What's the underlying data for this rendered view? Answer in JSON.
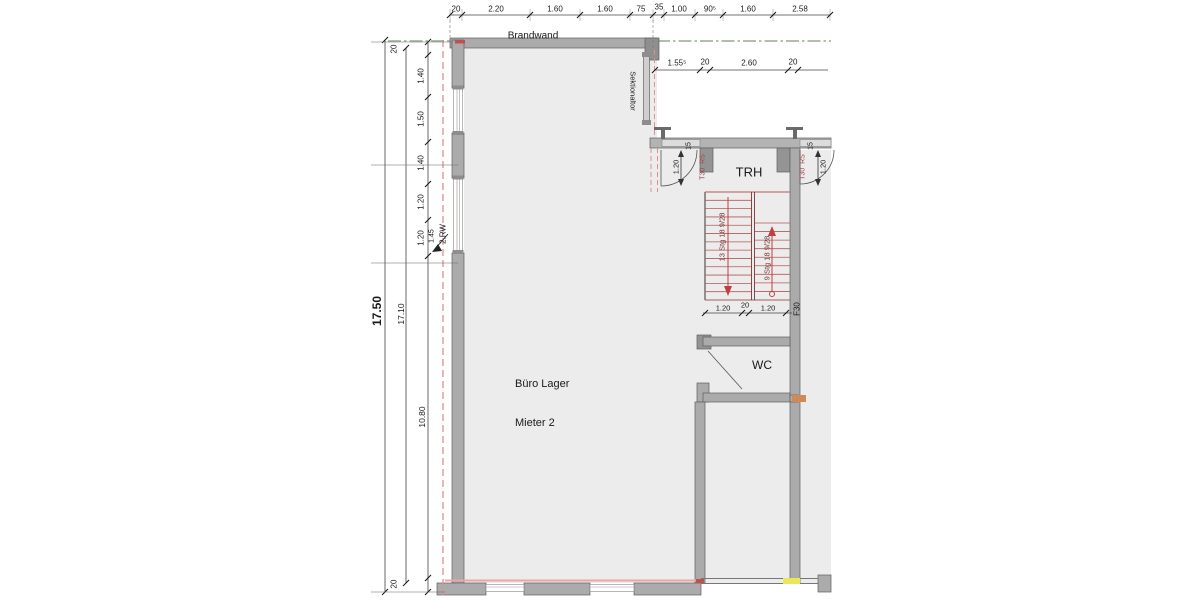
{
  "labels": {
    "brandwand": "Brandwand",
    "sektionaltor": "Sektionaltor",
    "trh": "TRH",
    "wc": "WC",
    "f30": "F30",
    "room_line1": "Büro Lager",
    "room_line2": "Mieter 2",
    "rw": "2.RW",
    "rw_dim": "1.45"
  },
  "doors": {
    "left": {
      "type": "T30  RS",
      "width": "1.20",
      "offset": "15"
    },
    "right": {
      "type": "T30  RS",
      "width": "1.20",
      "offset": "15"
    }
  },
  "stairs": {
    "left_flight": "13 Stg 18 9/28",
    "right_flight": "9 Stg 18 9/28",
    "chain": [
      "1.20",
      "20",
      "1.20"
    ]
  },
  "dims": {
    "top": [
      "20",
      "2.20",
      "1.60",
      "1.60",
      "75",
      "35",
      "1.00",
      "90⁵",
      "1.60",
      "2.58"
    ],
    "upper_right": [
      "1.55⁵",
      "20",
      "2.60",
      "20"
    ],
    "left_total": "17.50",
    "left_inner": "17.10",
    "left_top_offset": "20",
    "left_segments": [
      "1.40",
      "1.50",
      "1.40",
      "1.20",
      "1.20"
    ],
    "left_lower": "10.80",
    "left_bottom_offset": "20"
  },
  "colors": {
    "wall": "#ababab",
    "floor": "#ececec",
    "fire_dashed": "#dc9090",
    "stair_red": "#b35a5a",
    "axis_green": "#94ab90",
    "accent_yellow": "#e8e85a",
    "accent_orange": "#cf8a55"
  }
}
